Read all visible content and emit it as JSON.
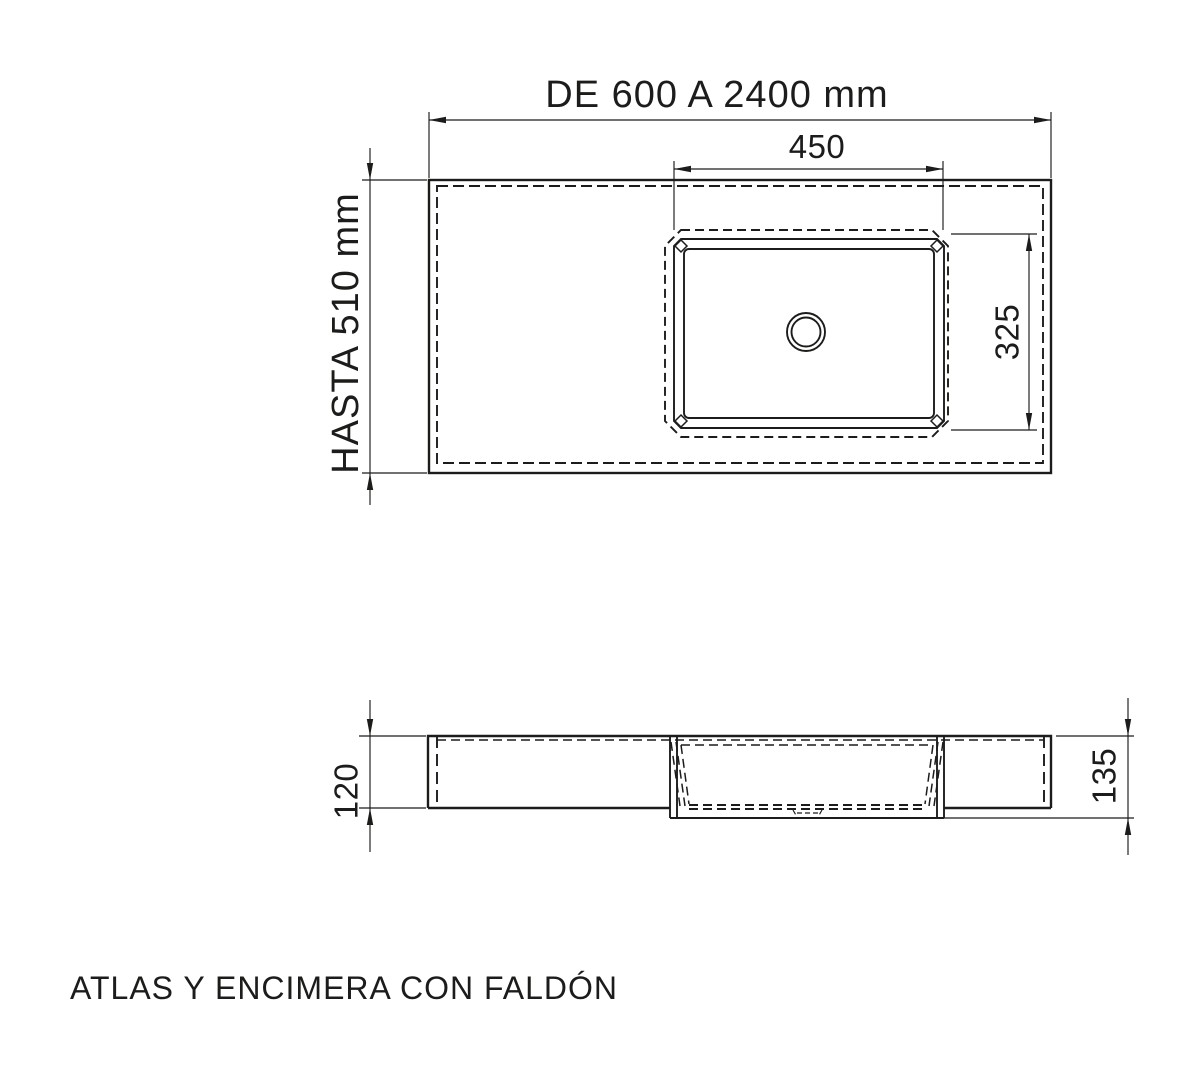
{
  "drawing": {
    "caption": "ATLAS Y ENCIMERA CON FALDÓN",
    "line_color": "#1c1c1a",
    "background_color": "#ffffff",
    "top_view": {
      "overall_width_label": "DE 600 A 2400 mm",
      "overall_depth_label": "HASTA 510 mm",
      "basin_width_label": "450",
      "basin_depth_label": "325"
    },
    "side_view": {
      "left_thickness_label": "120",
      "right_thickness_label": "135"
    }
  }
}
